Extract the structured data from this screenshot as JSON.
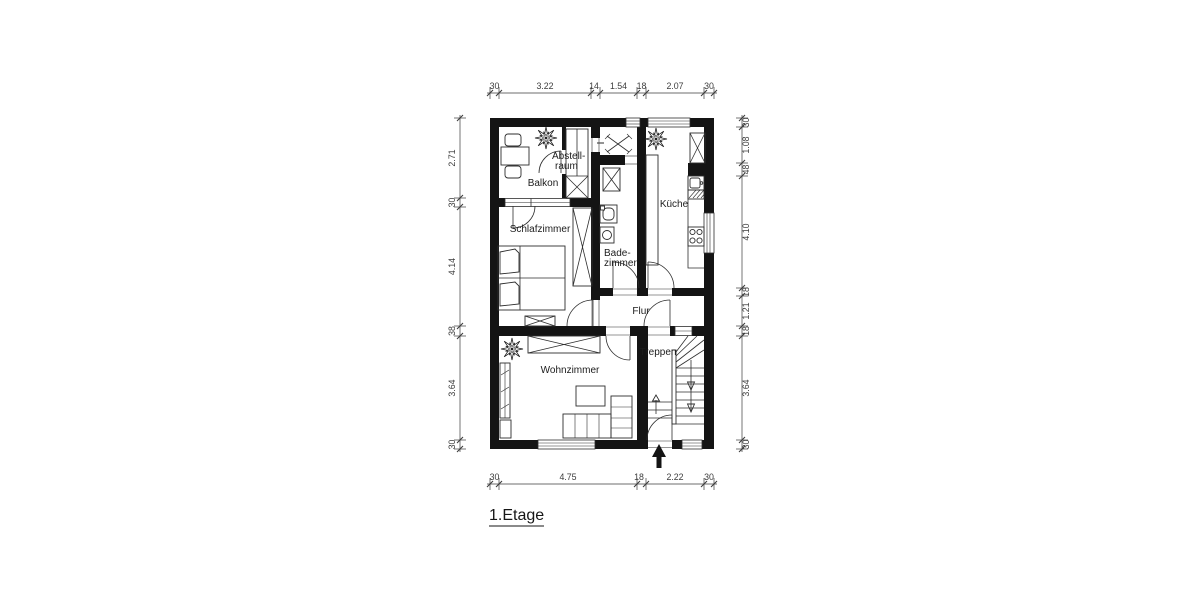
{
  "title": {
    "label": "1.Etage"
  },
  "rooms": {
    "balkon": "Balkon",
    "abstellraum_line1": "Abstell-",
    "abstellraum_line2": "raum",
    "schlafzimmer": "Schlafzimmer",
    "badezimmer_line1": "Bade-",
    "badezimmer_line2": "zimmer",
    "kueche": "Küche",
    "flur": "Flur",
    "treppen": "Treppen",
    "wohnzimmer": "Wohnzimmer"
  },
  "dimensions": {
    "top": [
      "30",
      "3.22",
      "14",
      "1.54",
      "18",
      "2.07",
      "30"
    ],
    "bottom": [
      "30",
      "4.75",
      "18",
      "2.22",
      "30"
    ],
    "left": [
      "2.71",
      "30",
      "4.14",
      "38",
      "3.64",
      "30"
    ],
    "right": [
      "30",
      "1.08",
      "48",
      "4.10",
      "18",
      "1.21",
      "18",
      "3.64",
      "30"
    ]
  },
  "colors": {
    "wall": "#141414",
    "line": "#2e2e2e",
    "dimension": "#3c3c3c",
    "background": "#ffffff"
  }
}
